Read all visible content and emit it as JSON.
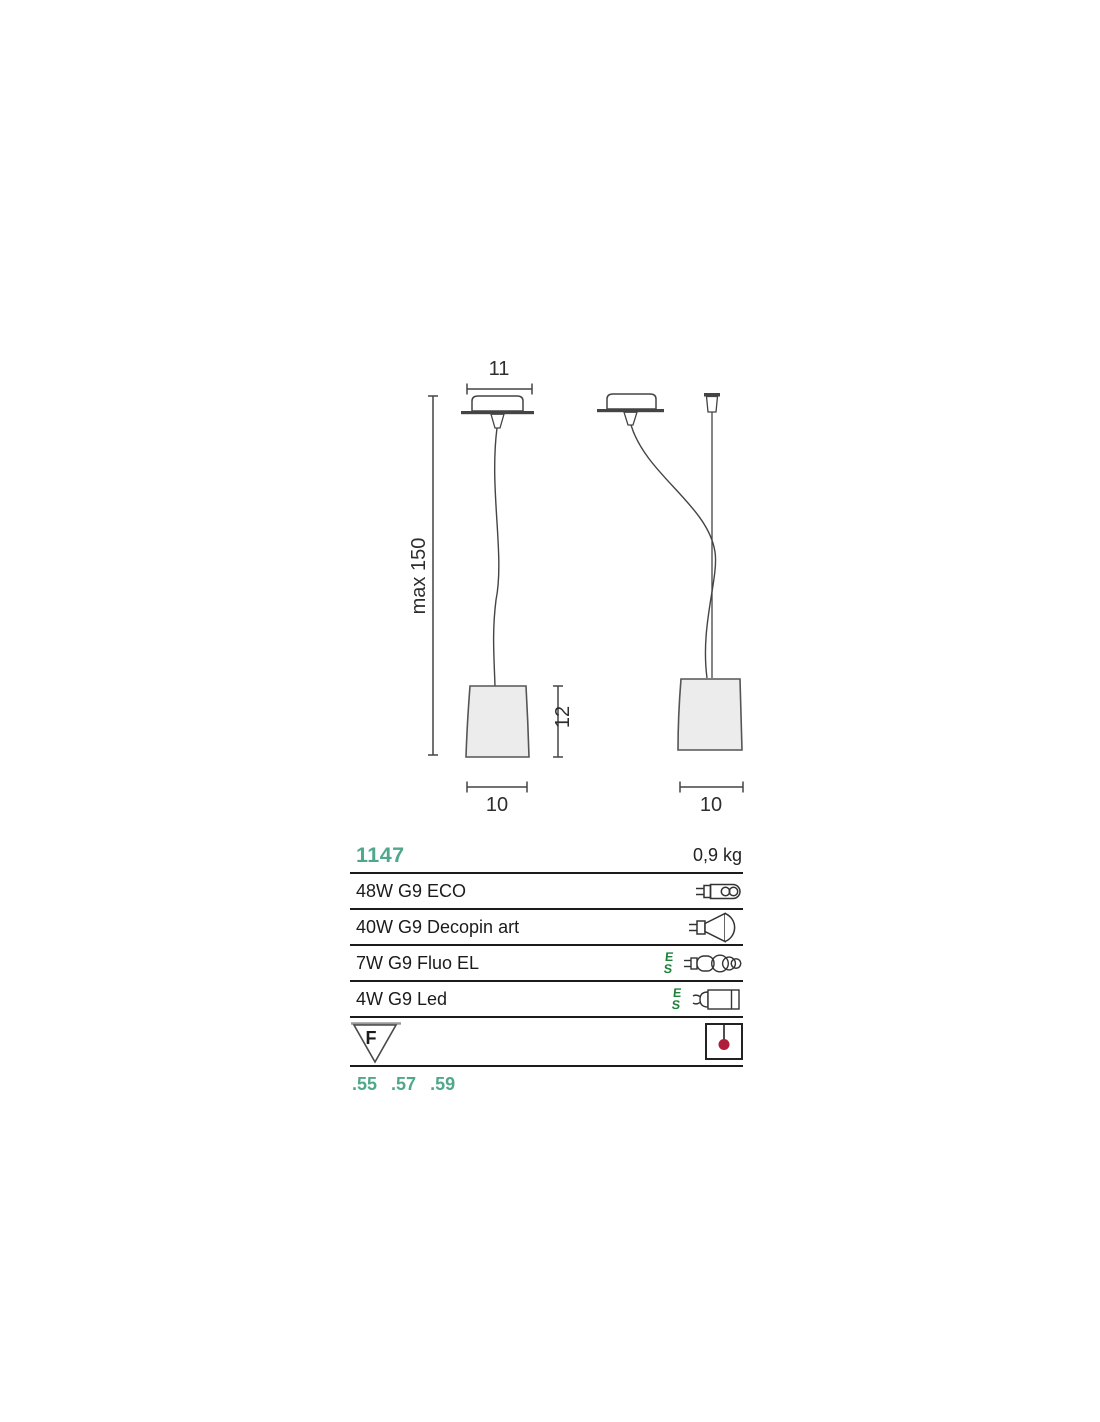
{
  "drawing": {
    "front_view": {
      "canopy_width_label": "11",
      "max_height_label": "max 150",
      "shade_height_label": "12",
      "shade_width_label": "10"
    },
    "side_view": {
      "shade_width_label": "10"
    }
  },
  "spec_table": {
    "model": "1147",
    "weight": "0,9 kg",
    "lamp_rows": [
      {
        "label": "48W G9 ECO",
        "icon": "halogen-capsule-icon"
      },
      {
        "label": "40W G9 Decopin art",
        "icon": "reflector-bulb-icon"
      },
      {
        "label": "7W G9 Fluo EL",
        "icon": "fluorescent-bulb-icon",
        "es_mark": "ES"
      },
      {
        "label": "4W G9 Led",
        "icon": "led-bulb-icon",
        "es_mark": "ES"
      }
    ],
    "f_mark_label": "F",
    "finishes": [
      ".55",
      ".57",
      ".59"
    ]
  },
  "colors": {
    "accent_teal": "#4FA78C",
    "energy_green": "#1E8238",
    "pendant_dot_red": "#B01E3C",
    "line_gray": "#444444",
    "shade_fill": "#ECECEC"
  }
}
